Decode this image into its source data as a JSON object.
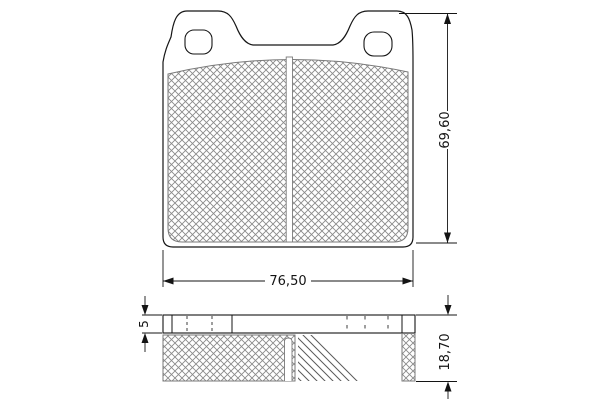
{
  "drawing": {
    "kind": "brake-pad-technical-drawing",
    "dims": {
      "width": "76,50",
      "height": "69,60",
      "plate": "5",
      "total": "18,70"
    },
    "colors": {
      "background": "#ffffff",
      "outline": "#161616",
      "hatch": "#8a8a8a",
      "chamfer_hatch": "#5a5a5a",
      "dimension": "#141414"
    }
  }
}
